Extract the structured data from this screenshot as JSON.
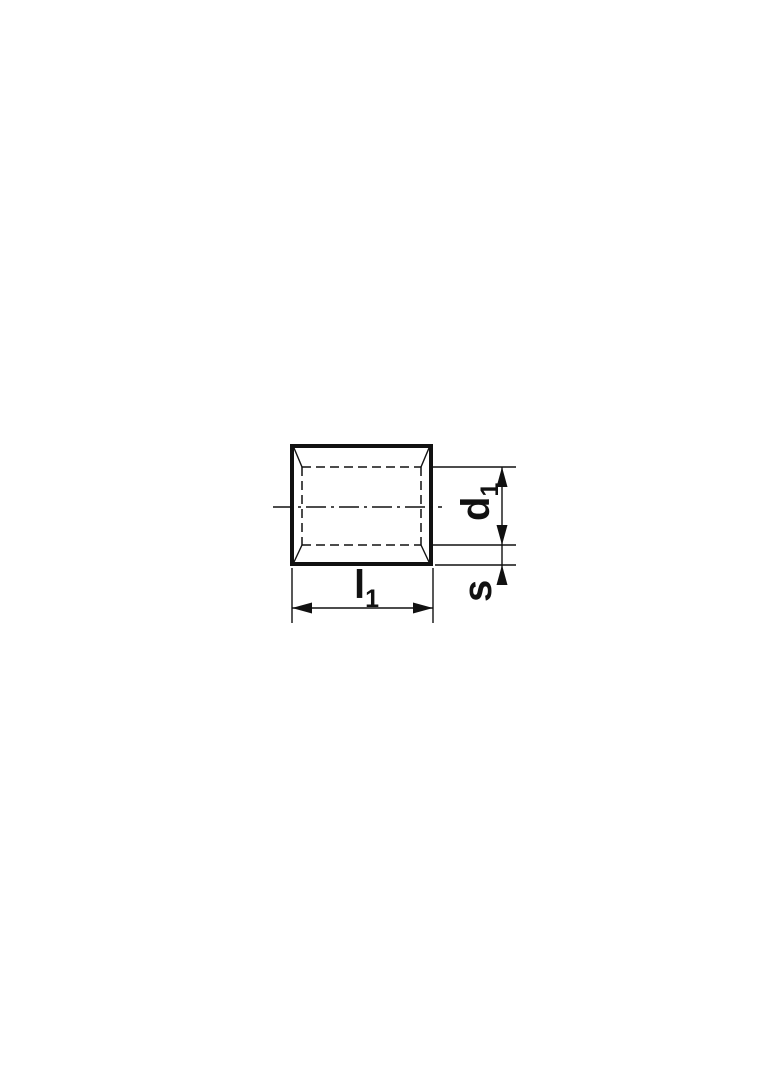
{
  "colors": {
    "line": "#111111",
    "background": "#ffffff"
  },
  "dimensions": {
    "inner_diameter": {
      "base": "d",
      "sub": "1"
    },
    "wall_thickness": {
      "base": "s",
      "sub": ""
    },
    "length": {
      "base": "l",
      "sub": "1"
    }
  }
}
